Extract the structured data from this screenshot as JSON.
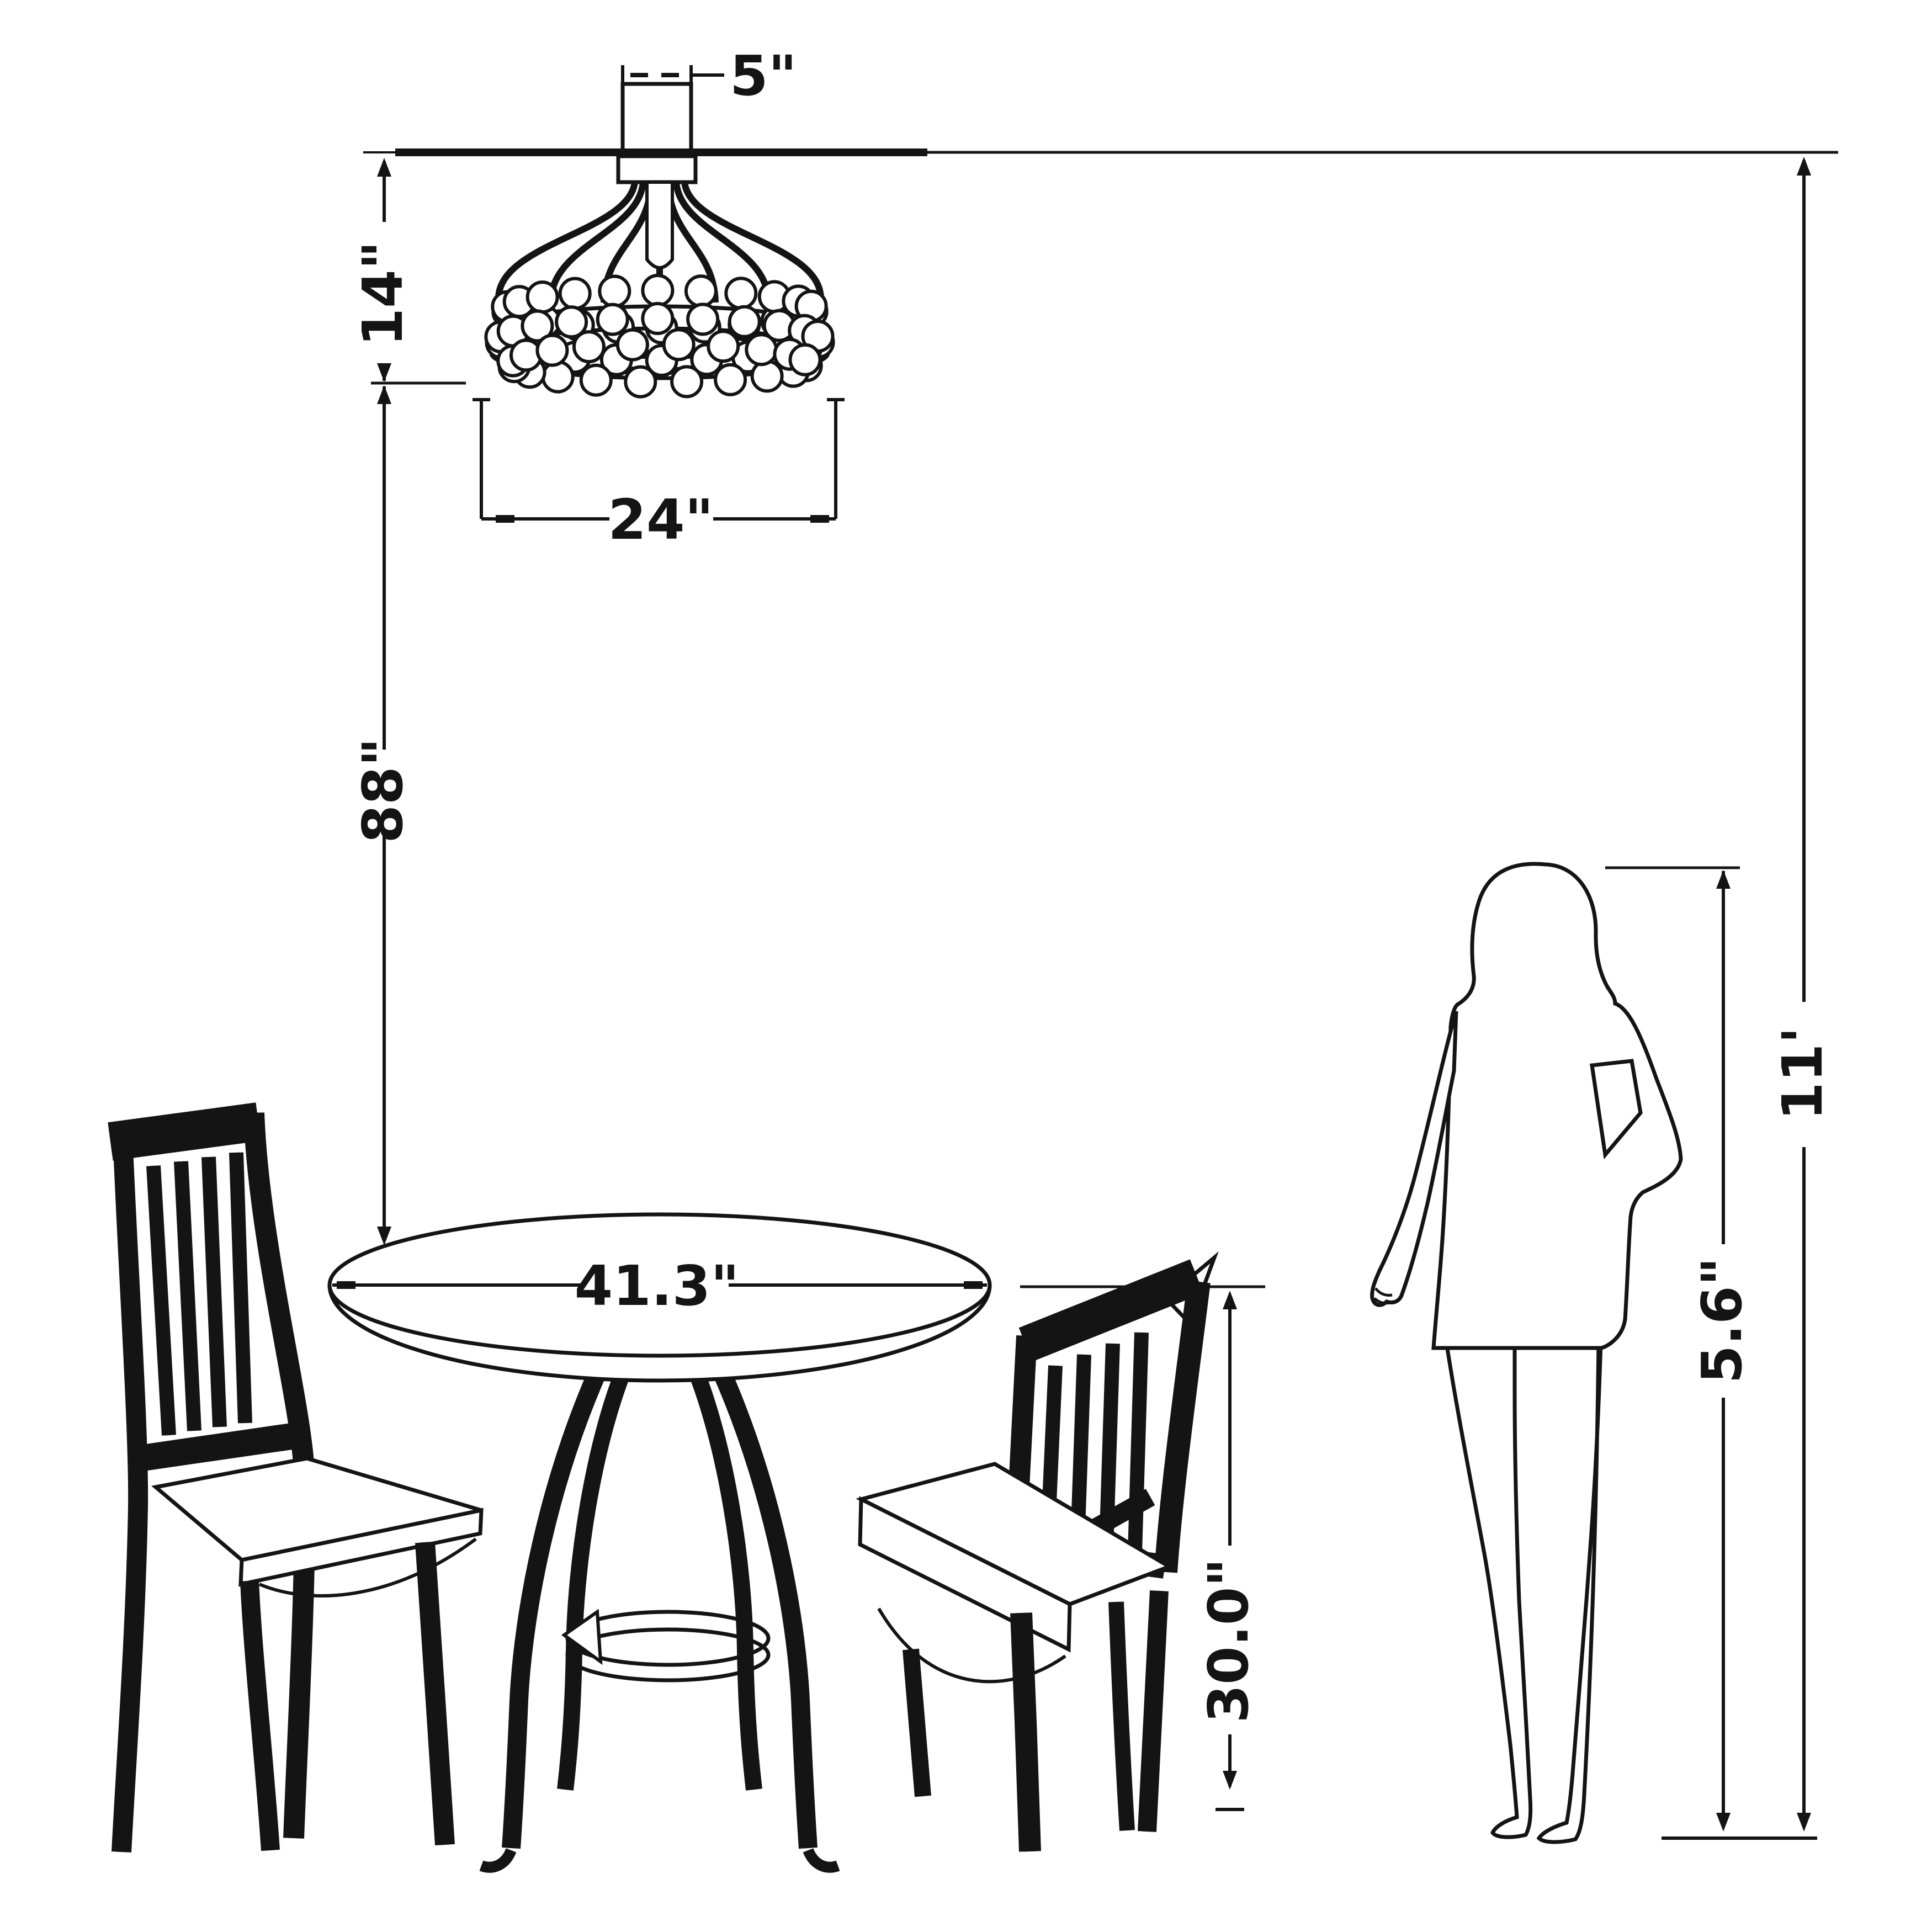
{
  "drawing": {
    "type": "furniture-dimension-diagram",
    "background_color": "#ffffff",
    "ink_color": "#141414",
    "dimensions": {
      "canopy_width": "5\"",
      "chandelier_height": "14\"",
      "chandelier_diameter": "24\"",
      "ceiling_to_tabletop": "88\"",
      "table_diameter": "41.3\"",
      "table_height": "30.0\"",
      "person_height": "5.6\"",
      "ceiling_height": "11'"
    }
  }
}
